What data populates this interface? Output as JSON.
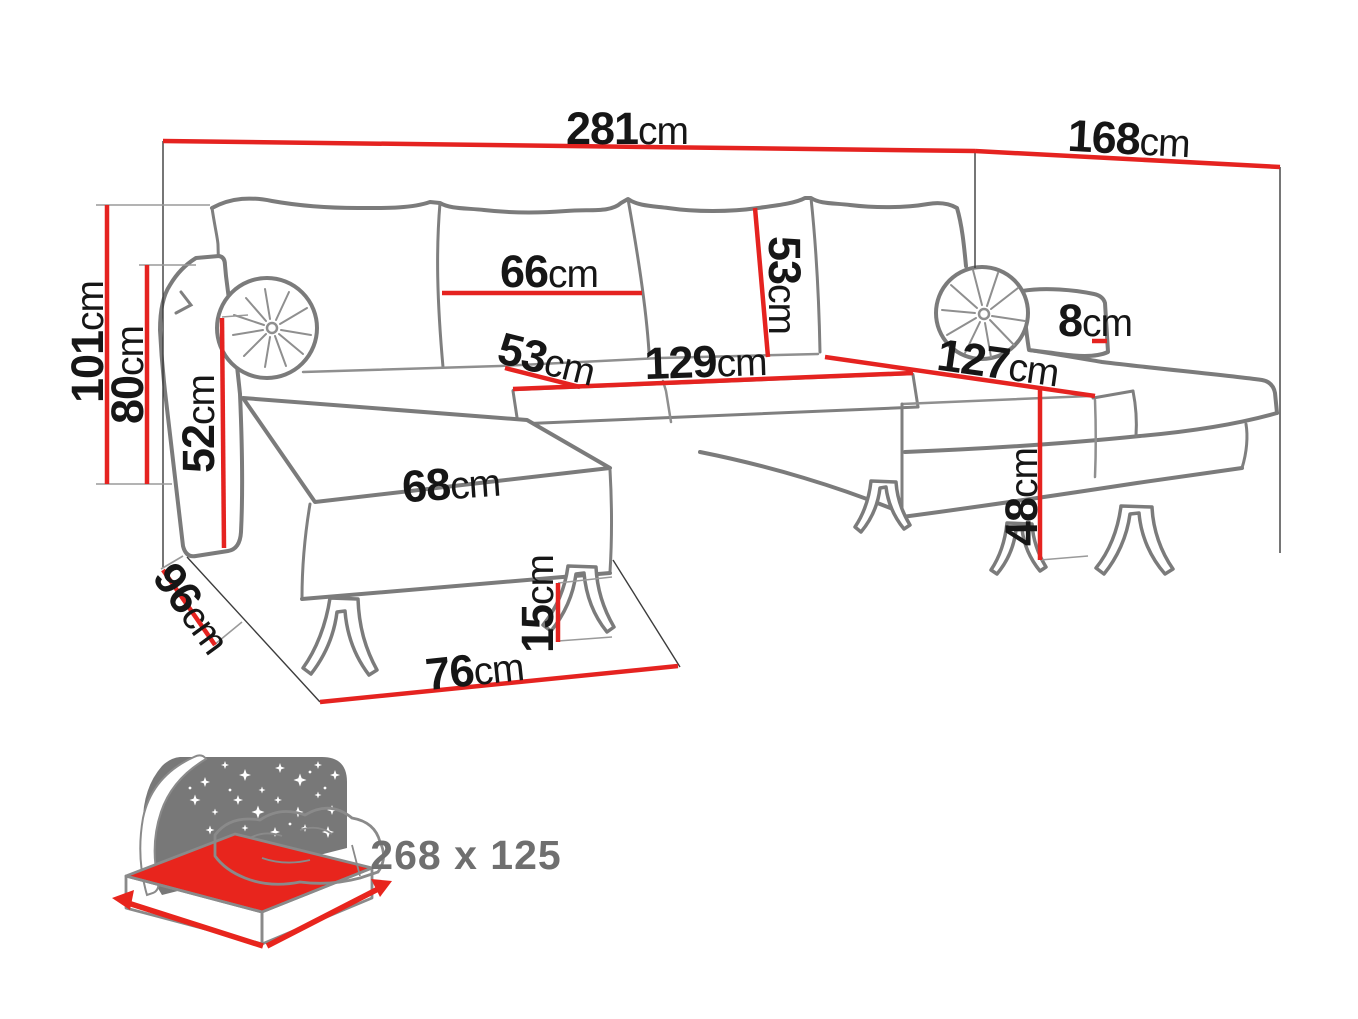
{
  "diagram": {
    "type": "furniture-dimension-diagram",
    "product": "U-shaped corner sofa bed with sleeping function",
    "unit": "cm",
    "colors": {
      "dimension_line": "#e52320",
      "outline_gray": "#7b7b7b",
      "label_text": "#161616",
      "bed_icon_gray": "#787878",
      "bed_icon_text": "#6f6f6f",
      "mattress_red": "#e8251d"
    },
    "dims": {
      "total_width": {
        "value": "281",
        "unit": "cm"
      },
      "total_depth_right": {
        "value": "168",
        "unit": "cm"
      },
      "total_height": {
        "value": "101",
        "unit": "cm"
      },
      "back_height": {
        "value": "80",
        "unit": "cm"
      },
      "armrest_height": {
        "value": "52",
        "unit": "cm"
      },
      "chaise_depth_left": {
        "value": "96",
        "unit": "cm"
      },
      "back_cushion_width": {
        "value": "66",
        "unit": "cm"
      },
      "back_cushion_height": {
        "value": "53",
        "unit": "cm"
      },
      "seat_depth": {
        "value": "53",
        "unit": "cm"
      },
      "seat_width": {
        "value": "129",
        "unit": "cm"
      },
      "chaise_length_right": {
        "value": "127",
        "unit": "cm"
      },
      "armrest_width_right": {
        "value": "8",
        "unit": "cm"
      },
      "chaise_seat_width": {
        "value": "68",
        "unit": "cm"
      },
      "seat_height": {
        "value": "48",
        "unit": "cm"
      },
      "leg_height": {
        "value": "15",
        "unit": "cm"
      },
      "chaise_width_front": {
        "value": "76",
        "unit": "cm"
      }
    },
    "sleeping_area": {
      "label": "268 x 125"
    }
  }
}
